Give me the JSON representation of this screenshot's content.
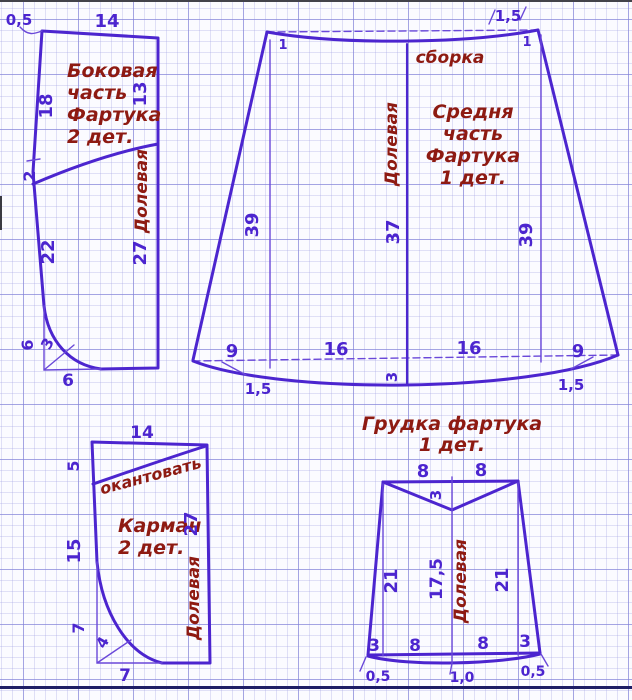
{
  "colors": {
    "ink": "#4c25cf",
    "ink_light": "#6a48d9",
    "label": "#8e1a12",
    "paper": "#fbfbff",
    "grid_major": "#9a9ade",
    "grid_minor": "#d9d9f1",
    "bottom_rule": "#1d1d66",
    "frame": "#43434a"
  },
  "pieces": {
    "side": {
      "title": [
        "Боковая",
        "часть",
        "Фартука",
        "2 дет."
      ],
      "grain": "Долевая",
      "dims": {
        "seam": "0,5",
        "top": "14",
        "left_upper": "18",
        "right_upper": "13",
        "left_mid": "2",
        "left_lower": "22",
        "right_lower": "27",
        "hem_side": "6",
        "hem_diag": "3",
        "hem_bottom": "6"
      }
    },
    "middle": {
      "title": [
        "Средня",
        "часть",
        "Фартука",
        "1 дет."
      ],
      "gather": "сборка",
      "grain": "Долевая",
      "dims": {
        "tick_left": "1",
        "tick_right": "1",
        "seam_top": "1,5",
        "left_height": "39",
        "center_height": "37",
        "right_height": "39",
        "bottom": [
          "9",
          "16",
          "16",
          "9"
        ],
        "hem_left": "1,5",
        "hem_center": "3",
        "hem_right": "1,5"
      }
    },
    "pocket": {
      "title": [
        "Карман",
        "2 дет."
      ],
      "binding": "окантовать",
      "grain": "Долевая",
      "dims": {
        "top": "14",
        "left_top": "5",
        "left_mid": "15",
        "right": "27",
        "corner_side": "7",
        "corner_diag": "4",
        "corner_bottom": "7"
      }
    },
    "bib": {
      "title": [
        "Грудка фартука",
        "1 дет."
      ],
      "grain": "Долевая",
      "dims": {
        "top_left": "8",
        "top_right": "8",
        "notch": "3",
        "left": "21",
        "center": "17,5",
        "right": "21",
        "bottom": [
          "3",
          "8",
          "8",
          "3"
        ],
        "ease": [
          "0,5",
          "1,0",
          "0,5"
        ]
      }
    }
  }
}
